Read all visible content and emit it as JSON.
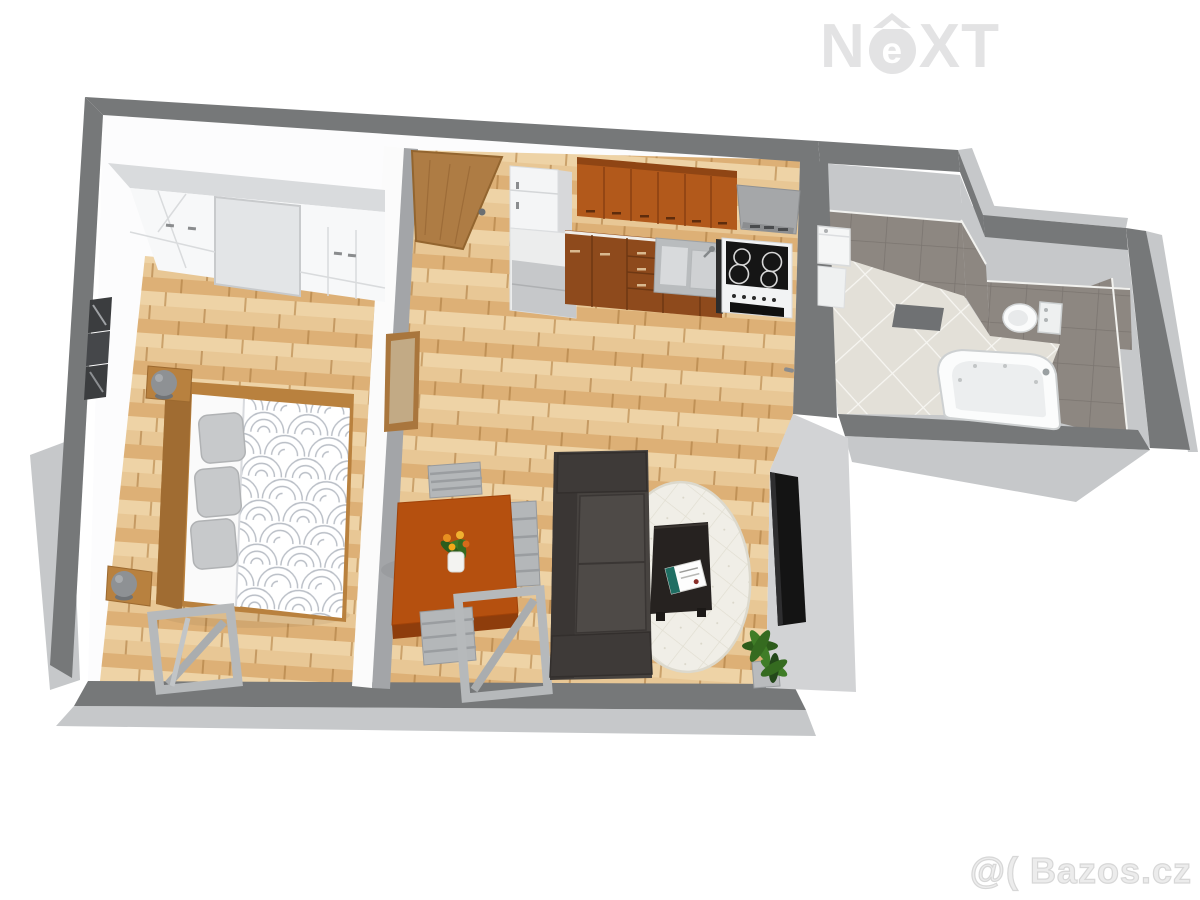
{
  "watermarks": {
    "brand_n": "N",
    "brand_e": "e",
    "brand_xt": "XT",
    "site": "@( Bazos.cz"
  },
  "scene": {
    "view": "3D floor plan of a one-bedroom apartment, top-down perspective render",
    "rooms": [
      {
        "name": "bedroom",
        "furniture": [
          "white-wardrobes",
          "double-bed-patterned-duvet",
          "gray-pillows",
          "nightstands-with-lamps",
          "wall-pictures",
          "folding-stool"
        ]
      },
      {
        "name": "living-room-with-kitchen",
        "furniture": [
          "entry-door",
          "wall-mirror",
          "fridge",
          "upper-kitchen-cabinets",
          "lower-kitchen-cabinets",
          "sink",
          "cooktop-with-oven",
          "range-hood",
          "dining-table",
          "flower-vase",
          "gray-chairs",
          "dark-sofa",
          "oval-rug",
          "coffee-table",
          "magazine",
          "wall-tv",
          "potted-plant"
        ]
      },
      {
        "name": "bathroom",
        "furniture": [
          "washing-machine",
          "bath-mat",
          "toilet",
          "corner-bathtub"
        ]
      }
    ],
    "palette": {
      "wall_dark": "#767879",
      "wall_face": "#c6c8ca",
      "interior_white": "#fcfcfd",
      "wood_floor": "#e3bb84",
      "cabinet_brown": "#b2591b",
      "table_brown": "#b5500f",
      "door_brown": "#ae7c44",
      "sofa_dark": "#474340",
      "rug_cream": "#f0eee7",
      "tile_taupe": "#8d8781",
      "bath_floor": "#e3e0d8",
      "accent_green": "#3f7d27"
    }
  }
}
